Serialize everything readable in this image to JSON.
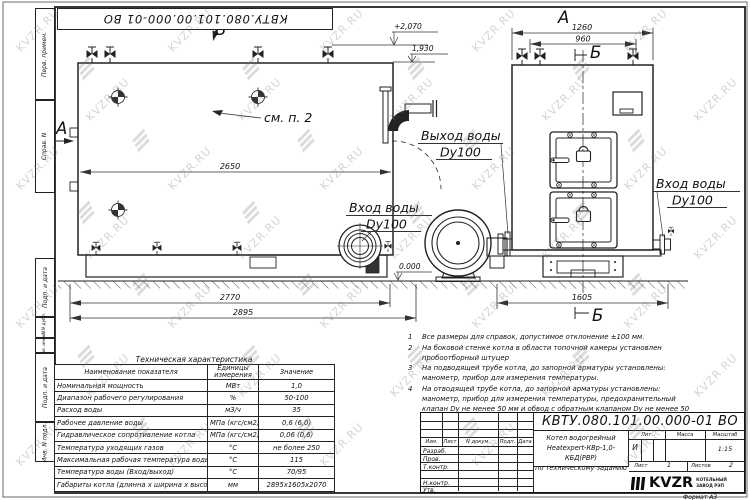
{
  "doc": {
    "number": "КВТУ.080.101.00.000-01 ВО",
    "name_line1": "Котел водогрейный",
    "name_line2": "Heatexpert-КВр-1,0-КБД(РВР)",
    "name_line3": "по техническому заданию",
    "liter_label": "Лит.",
    "mass_label": "Масса",
    "scale_label": "Масштаб",
    "liter": "И",
    "scale": "1:15",
    "sheet_label": "Лист",
    "sheet_value": "1",
    "sheets_label": "Листов",
    "sheets_value": "2",
    "logo_text": "KVZR",
    "logo_sub1": "КОТЕЛЬНЫЙ",
    "logo_sub2": "ЗАВОД РЭП",
    "format": "Формат  А3"
  },
  "title_block": {
    "header_cols": [
      "Изм.",
      "Лист",
      "N докум.",
      "Подп.",
      "Дата"
    ],
    "rows": [
      "Разраб.",
      "Пров.",
      "Т.контр.",
      "Н.контр.",
      "Утв."
    ]
  },
  "margin_labels": [
    "Перв. примен.",
    "Справ. N",
    "Подп. и дата",
    "Инв. N дубл.",
    "Взам. инв. N",
    "Подп. и дата",
    "Инв. N подл."
  ],
  "tech_table": {
    "title": "Техническая характеристика",
    "col_headers": [
      "Наименование показателя",
      "Единицы измерения",
      "Значение"
    ],
    "rows": [
      [
        "Номинальная мощность",
        "МВт",
        "1,0"
      ],
      [
        "Диапазон рабочего регулирования",
        "%",
        "50-100"
      ],
      [
        "Расход воды",
        "м3/ч",
        "35"
      ],
      [
        "Рабочее давление воды",
        "МПа (кгс/см2)",
        "0,6 (6,0)"
      ],
      [
        "Гидравлическое сопротивление котла",
        "МПа (кгс/см2)",
        "0,06 (0,6)"
      ],
      [
        "Температура уходящих газов",
        "°С",
        "не более 250"
      ],
      [
        "Максимальная рабочая температура воды",
        "°С",
        "115"
      ],
      [
        "Температура воды (Вход/выход)",
        "°С",
        "70/95"
      ],
      [
        "Габариты котла (длинна х ширина х высота)",
        "мм",
        "2895х1605х2070"
      ]
    ]
  },
  "notes": [
    {
      "num": "1",
      "text": "Все размеры для справок, допустимое отклонение ±100 мм."
    },
    {
      "num": "2",
      "text": "На боковой стенке котла в области топочной камеры установлен пробоотборный штуцер"
    },
    {
      "num": "3",
      "text": "На  подводящей трубе котла, до запорной арматуры установлены: манометр, прибор для измерения температуры."
    },
    {
      "num": "4",
      "text": "На отводящей трубе котла, до запорной арматуры установлены: манометр, прибор для измерения температуры, предохранительный клапан Dу не менее 50 мм и обвод с обратным клапаном Dу не менее 50 мм."
    }
  ],
  "drawing": {
    "labels": {
      "view_a": "А",
      "view_b": "В",
      "view_front": "А",
      "section_b_top": "Б",
      "section_b_bottom": "Б",
      "outlet_line1": "Выход воды",
      "outlet_line2": "Dy100",
      "inlet_side_line1": "Вход воды",
      "inlet_side_line2": "Dy100",
      "inlet_front_line1": "Вход воды",
      "inlet_front_line2": "Dy100",
      "see_note": "см. п. 2",
      "elev_top": "+2,070",
      "elev_mid": "1,930",
      "elev_zero": "0.000"
    },
    "dims": {
      "d2650": "2650",
      "d2770": "2770",
      "d2895": "2895",
      "d1260": "1260",
      "d960": "960",
      "d1605": "1605"
    }
  },
  "watermark": {
    "text": "KVZR.RU"
  }
}
